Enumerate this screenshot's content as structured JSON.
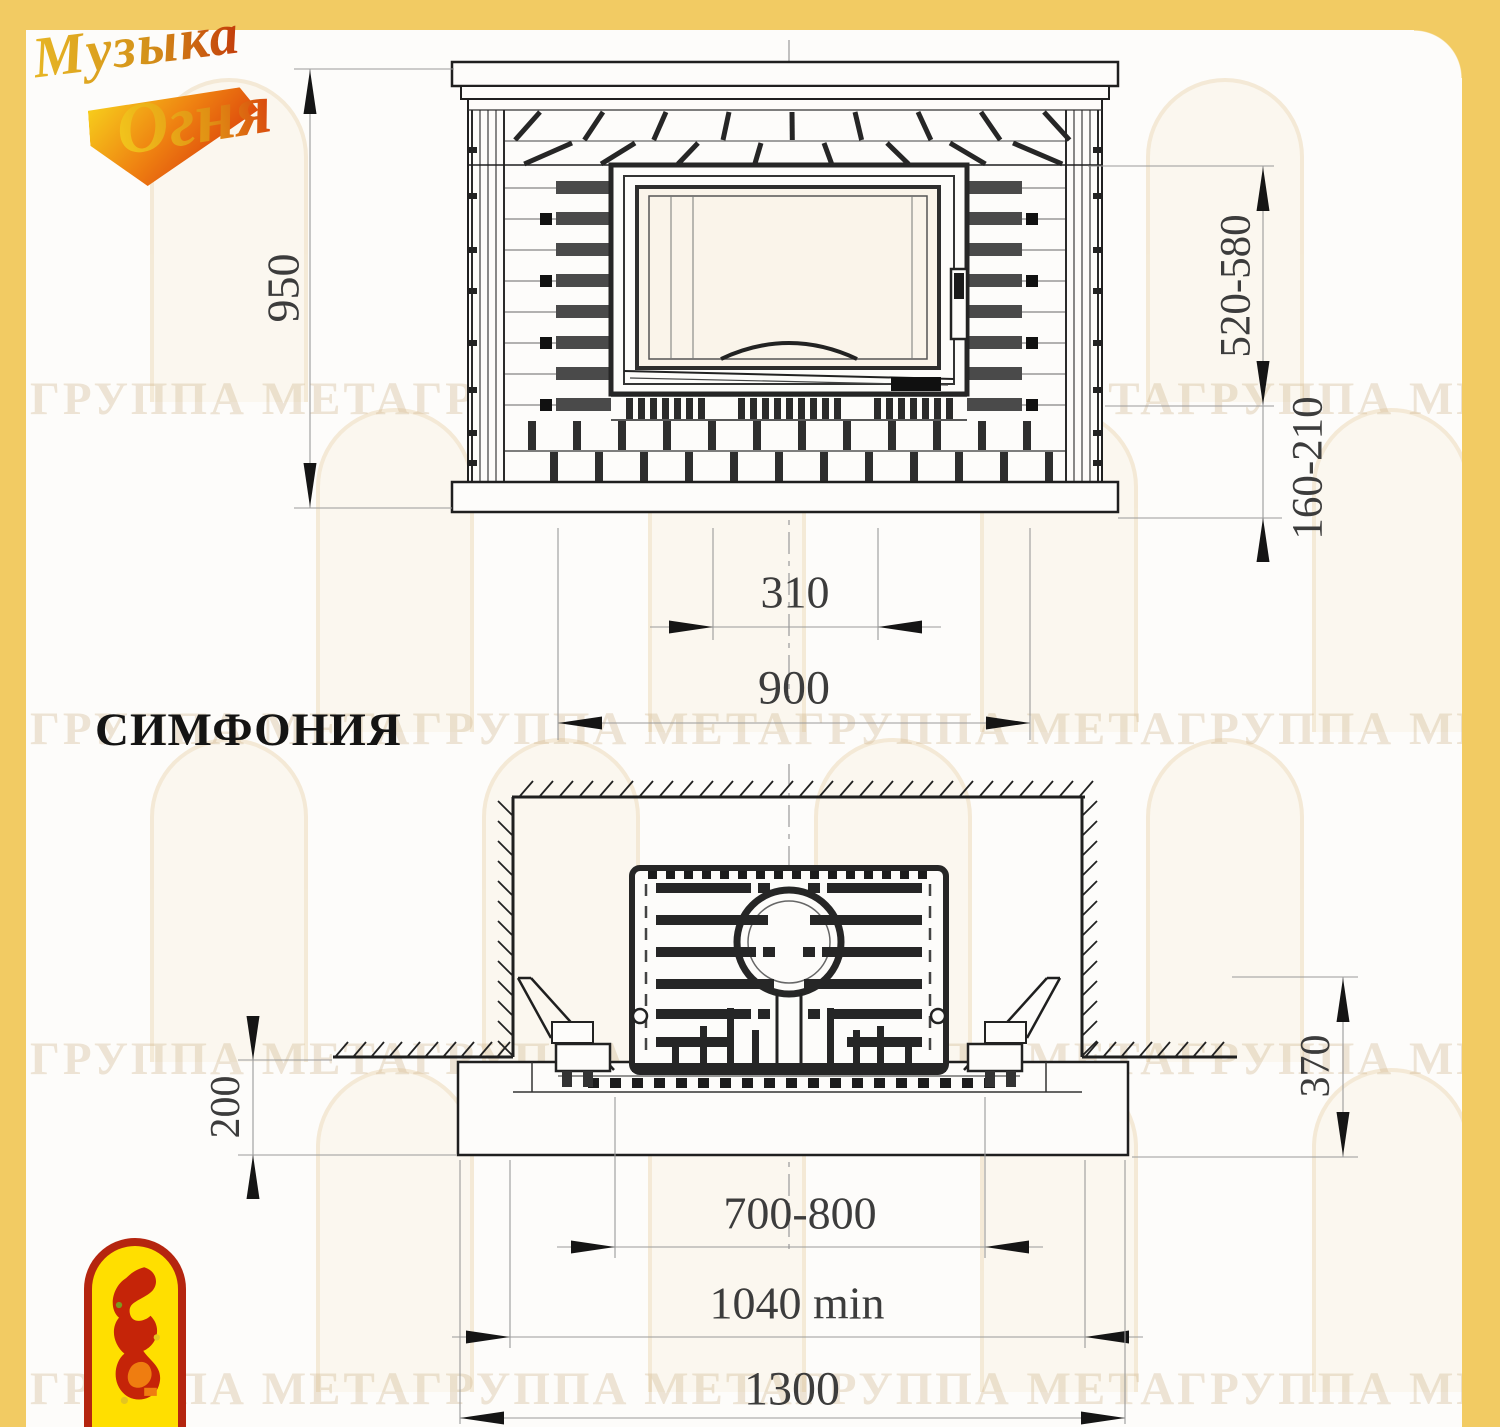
{
  "brand": {
    "logo_line1": "Музыка",
    "logo_line2": "Огня"
  },
  "title": "СИМФОНИЯ",
  "watermark_text": "ГРУППА МЕТАГРУППА МЕТАГРУППА МЕТАГРУППА МЕТАГРУППА",
  "front_view": {
    "dim_height": "950",
    "dim_opening_height": "520-580",
    "dim_hearth_height": "160-210",
    "dim_opening_width": "310",
    "dim_width": "900"
  },
  "plan_view": {
    "dim_hearth_depth": "200",
    "dim_side_depth": "370",
    "dim_opening_width": "700-800",
    "dim_min_width": "1040 min",
    "dim_total_width": "1300"
  },
  "colors": {
    "accent_yellow": "#f2cb63",
    "line_dark": "#1f1f1f",
    "dimension_gray": "#999999",
    "logo_gold": "#d9a11d",
    "logo_red": "#c33b0a",
    "emblem_yellow": "#ffdf00",
    "emblem_red": "#b5250f"
  }
}
